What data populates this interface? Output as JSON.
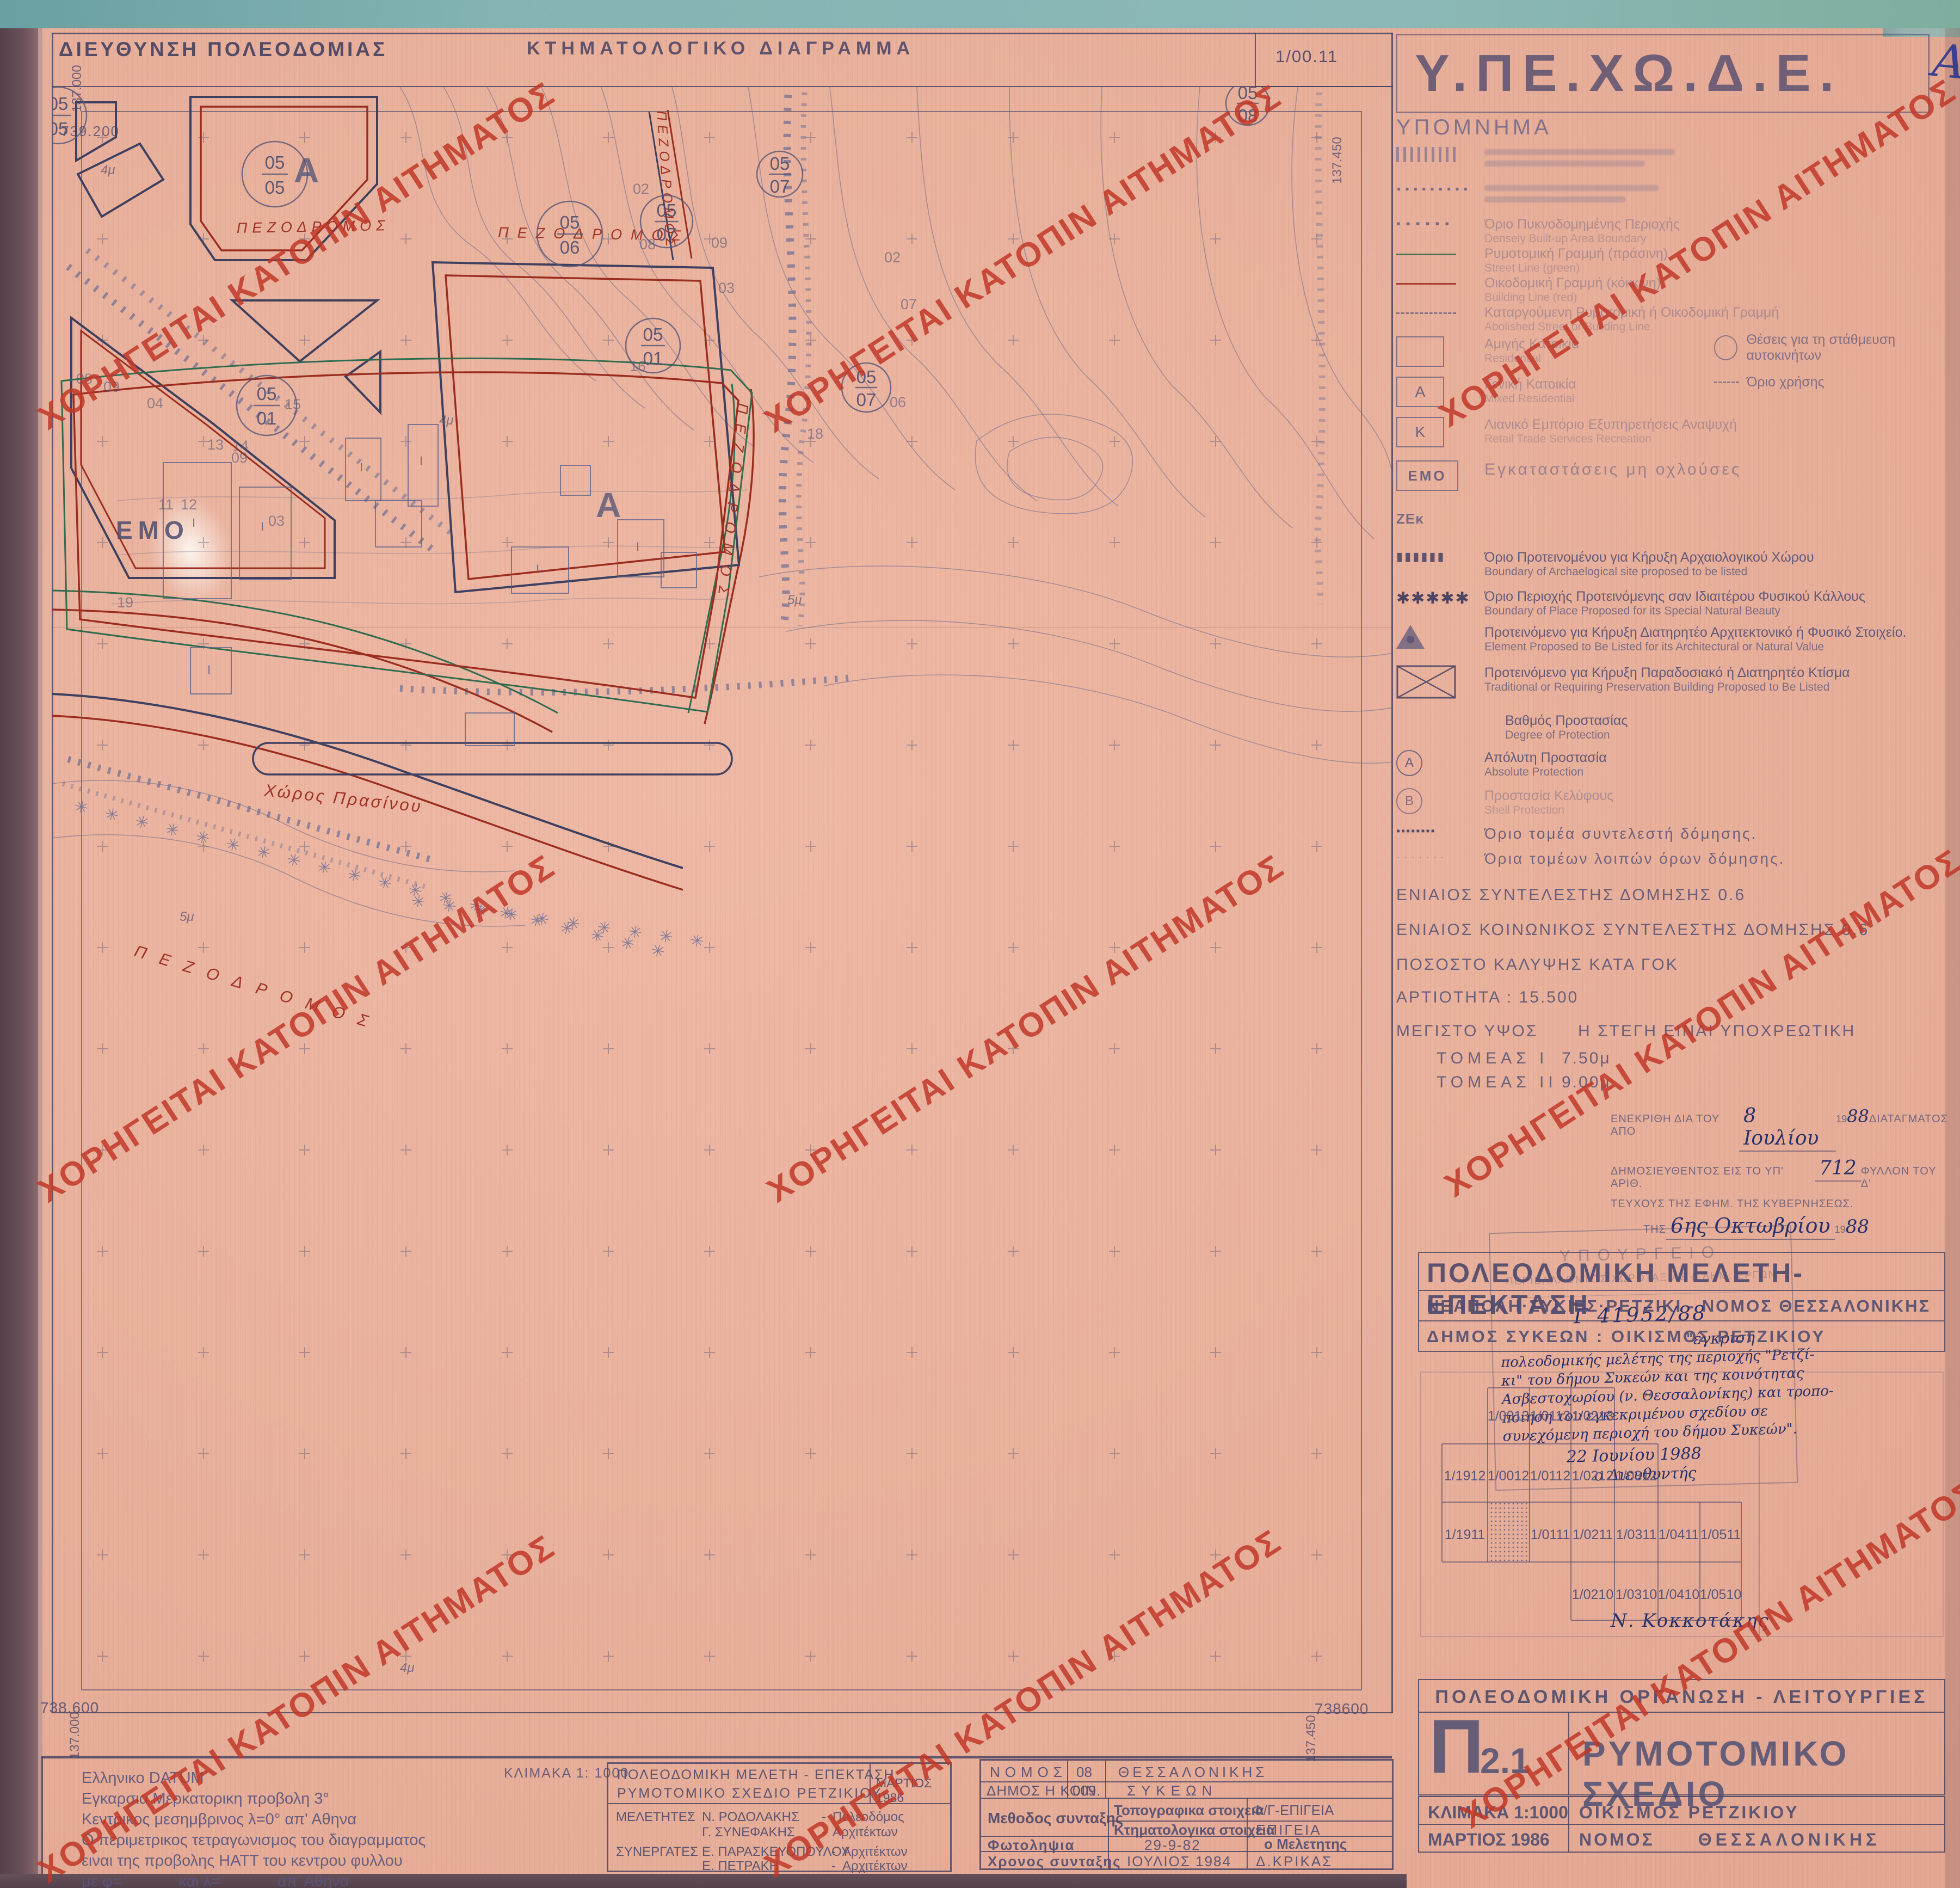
{
  "watermark": {
    "text": "ΧΟΡΗΓΕΙΤΑΙ ΚΑΤΟΠΙΝ ΑΙΤΗΜΑΤΟΣ",
    "color": "#c1372b"
  },
  "header": {
    "left_title": "ΔΙΕΥΘΥΝΣΗ ΠΟΛΕΟΔΟΜΙΑΣ",
    "center_title": "ΚΤΗΜΑΤΟΛΟΓΙΚΟ ΔΙΑΓΡΑΜΜΑ",
    "sheet_no": "1/00.11"
  },
  "map": {
    "corners": {
      "top_n": "739.200",
      "left_e": "137.000",
      "right_e": "137.450",
      "bottom_left_n": "738.600",
      "bottom_right_n": "738600"
    },
    "street_label": "ΠΕΖΟΔΡΟΜΟΣ",
    "green_space": "Χώρος Πρασίνου",
    "emo": "ΕΜΟ",
    "zone_a": "Α",
    "building_mark": "I",
    "stars_long": "✳ ✳ ✳ ✳ ✳ ✳ ✳ ✳ ✳ ✳ ✳ ✳ ✳ ✳ ✳ ✳ ✳ ✳ ✳ ✳",
    "stars_short": "✳ ✳ ✳ ✳ ✳ ✳ ✳ ✳ ✳ ✳",
    "circles": [
      {
        "t": "05",
        "b": "05"
      },
      {
        "t": "05",
        "b": "05"
      },
      {
        "t": "05",
        "b": "06"
      },
      {
        "t": "05",
        "b": "07"
      },
      {
        "t": "05",
        "b": "07"
      },
      {
        "t": "05",
        "b": "01"
      },
      {
        "t": "05",
        "b": "01"
      },
      {
        "t": "05",
        "b": "07"
      },
      {
        "t": "05",
        "b": "08"
      }
    ],
    "plots": [
      "08",
      "09",
      "04",
      "09",
      "03",
      "11",
      "12",
      "13",
      "14",
      "15",
      "19",
      "16",
      "18",
      "02",
      "07",
      "06",
      "08",
      "09",
      "02",
      "03"
    ],
    "dims": [
      "4μ",
      "4μ",
      "5μ",
      "5μ",
      "4μ"
    ]
  },
  "panel": {
    "agency": "Υ.ΠΕ.ΧΩ.Δ.Ε.",
    "annotation_a": "A",
    "legend_title": "ΥΠΟΜΝΗΜΑ",
    "zek": "ΖΕκ",
    "syms": {
      "sq_dots": "▪ ▪ ▪ ▪ ▪ ▪",
      "dots": "·········",
      "arch": "▮▮▮▮▮▮",
      "stars": "✱✱✱✱✱",
      "dot_row": "▪▪▪▪▪▪▪▪",
      "dot_faint": "· · · · · · ·",
      "rect_a": "Α",
      "rect_k": "Κ",
      "rect_emo": "ΕΜΟ",
      "circ_a": "Α",
      "circ_b": "Β"
    },
    "items": [
      {
        "gr": "Όριο Πυκνοδομημένης Περιοχής",
        "en": "Densely Built-up Area Boundary"
      },
      {
        "gr": "Ρυμοτομική Γραμμή (πράσινη)",
        "en": "Street Line (green)"
      },
      {
        "gr": "Οικοδομική Γραμμή (κόκκινη)",
        "en": "Building Line (red)"
      },
      {
        "gr": "Καταργούμενη Ρυμοτομική ή Οικοδομική Γραμμή",
        "en": "Abolished Street or Building Line"
      },
      {
        "gr": "Αμιγής Κατοικία",
        "en": "Residential"
      },
      {
        "gr": "Γενική Κατοικία",
        "en": "Mixed Residential"
      },
      {
        "gr": "Λιανικό Εμπόριο Εξυπηρετήσεις Αναψυχή",
        "en": "Retail Trade Services Recreation"
      },
      {
        "gr": "Εγκαταστάσεις μη οχλούσες",
        "en": ""
      },
      {
        "gr": "Όριο Προτεινομένου για Κήρυξη Αρχαιολογικού Χώρου",
        "en": "Boundary of Archaelogical site proposed to be listed"
      },
      {
        "gr": "Όριο Περιοχής Προτεινόμενης σαν Ιδιαιτέρου Φυσικού Κάλλους",
        "en": "Boundary of Place Proposed for its Special Natural Beauty"
      },
      {
        "gr": "Προτεινόμενο για Κήρυξη Διατηρητέο Αρχιτεκτονικό ή Φυσικό Στοιχείο.",
        "en": "Element Proposed to Be Listed for its Architectural or Natural Value"
      },
      {
        "gr": "Προτεινόμενο για Κήρυξη Παραδοσιακό ή Διατηρητέο Κτίσμα",
        "en": "Traditional or Requiring Preservation Building Proposed to Be Listed"
      },
      {
        "gr": "Βαθμός Προστασίας",
        "en": "Degree of Protection"
      },
      {
        "gr": "Απόλυτη Προστασία",
        "en": "Absolute Protection"
      },
      {
        "gr": "Προστασία Κελύφους",
        "en": "Shell Protection"
      },
      {
        "gr": "Όριο τομέα συντελεστή δόμησης.",
        "en": ""
      },
      {
        "gr": "Όρια τομέων λοιπών όρων δόμησης.",
        "en": ""
      }
    ],
    "parking": "Θέσεις για τη στάθμευση αυτοκινήτων",
    "use_boundary": "Όριο χρήσης",
    "regulations": [
      "ΕΝΙΑΙΟΣ ΣΥΝΤΕΛΕΣΤΗΣ ΔΟΜΗΣΗΣ 0.6",
      "ΕΝΙΑΙΟΣ ΚΟΙΝΩΝΙΚΟΣ ΣΥΝΤΕΛΕΣΤΗΣ ΔΟΜΗΣΗΣ 0.6",
      "ΠΟΣΟΣΤΟ ΚΑΛΥΨΗΣ ΚΑΤΑ ΓΟΚ",
      "ΑΡΤΙΟΤΗΤΑ : 15.500"
    ],
    "height": {
      "label": "ΜΕΓΙΣΤΟ ΥΨΟΣ",
      "roof_note": "Η ΣΤΕΓΗ ΕΙΝΑΙ ΥΠΟΧΡΕΩΤΙΚΗ",
      "s1": "ΤΟΜΕΑΣ Ι",
      "s1v": "7.50μ",
      "s2": "ΤΟΜΕΑΣ ΙΙ",
      "s2v": "9.00μ"
    },
    "approval": {
      "l1a": "ΕΝΕΚΡΙΘΗ ΔΙΑ ΤΟΥ ΑΠΟ",
      "l1hw": "8 Ιουλίου",
      "y1": "19",
      "y1hw": "88",
      "l1b": "ΔΙΑΤΑΓΜΑΤΟΣ",
      "l2a": "ΔΗΜΟΣΙΕΥΘΕΝΤΟΣ ΕΙΣ ΤΟ ΥΠ' ΑΡΙΘ.",
      "l2hw": "712",
      "l2b": "ΦΥΛΛΟΝ ΤΟΥ Δ'",
      "l3": "ΤΕΥΧΟΥΣ ΤΗΣ ΕΦΗΜ. ΤΗΣ ΚΥΒΕΡΝΗΣΕΩΣ.",
      "l4a": "ΤΗΣ",
      "l4hw": "6ης Οκτωβρίου",
      "y4": "19",
      "y4hw": "88"
    },
    "stamp": {
      "h1": "ΥΠΟΥΡΓΕΙΟ",
      "h2": "ΠΕΡΙΒΑΛΛΟΝΤΟΣ ΧΩΡΟΤΑΞΙΑΣ & ΔΗΜ. ΕΡΓΩΝ",
      "protocol": "Γ 41952/88",
      "lines": [
        "\"έγκριση",
        "πολεοδομικής μελέτης της περιοχής \"Ρετζί-",
        "κι\" του δήμου Συκεών και της κοινότητας",
        "Ασβεστοχωρίου (ν. Θεσσαλονίκης) και τροπο-",
        "ποίηση του εγκεκριμένου σχεδίου σε",
        "συνεχόμενη περιοχή του δήμου Συκεών\".",
        "22 Ιουνίου 1988",
        "ο Διευθυντής"
      ],
      "signature": "Ν. Κοκκοτάκης"
    },
    "project": {
      "title": "ΠΟΛΕΟΔΟΜΙΚΗ ΜΕΛΕΤΗ-ΕΠΕΚΤΑΣΗ",
      "subtitle": "ΝΕΑΠΟΛΗ·ΣΥΚΙΕΣ·ΡΕΤΖΙΚΙ - ΝΟΜΟΣ ΘΕΣΣΑΛΟΝΙΚΗΣ",
      "municipality": "ΔΗΜΟΣ ΣΥΚΕΩΝ : ΟΙΚΙΣΜΟΣ ΡΕΤΖΙΚΙΟΥ"
    },
    "index": {
      "row1": [
        "1/0013",
        "1/0113",
        "1/0213"
      ],
      "row2": [
        "1/1912",
        "1/0012",
        "1/0112",
        "1/0212",
        "1/0312"
      ],
      "row3": [
        "1/1911",
        "1/0111",
        "1/0211",
        "1/0311",
        "1/0411",
        "1/0511"
      ],
      "row4": [
        "1/0210",
        "1/0310",
        "1/0410",
        "1/0510"
      ]
    },
    "title_block": {
      "header": "ΠΟΛΕΟΔΟΜΙΚΗ ΟΡΓΑΝΩΣΗ - ΛΕΙΤΟΥΡΓΙΕΣ",
      "code_letter": "Π",
      "code_no": "2.1",
      "name": "ΡΥΜΟΤΟΜΙΚΟ ΣΧΕΔΙΟ",
      "scale": "ΚΛΙΜΑΚΑ 1:1000",
      "settlement": "ΟΙΚΙΣΜΟΣ ΡΕΤΖΙΚΙΟΥ",
      "date": "ΜΑΡΤΙΟΣ 1986",
      "pref_label": "ΝΟΜΟΣ",
      "pref_value": "ΘΕΣΣΑΛΟΝΙΚΗΣ"
    }
  },
  "bottom": {
    "datum": [
      "Ελληνικο DATUM",
      "Εγκαρσια Μερκατορικη προβολη 3°",
      "Κεντρικος μεσημβρινος λ=0° απ' Αθηνα",
      "Ο περιμετρικος τετραγωνισμος του διαγραμματος",
      "ειναι της προβολης ΗΑΤΤ του κεντρου φυλλου",
      "με φ=             και λ=             απ' Αθηνα"
    ],
    "scale_label": "ΚΛΙΜΑΚΑ 1: 1000",
    "study": {
      "t1": "ΠΟΛΕΟΔΟΜΙΚΗ ΜΕΛΕΤΗ - ΕΠΕΚΤΑΣΗ",
      "t2": "ΡΥΜΟΤΟΜΙΚΟ ΣΧΕΔΙΟ ΡΕΤΖΙΚΙΟΥ",
      "date": "ΜΑΡΤΙΟΣ 1986",
      "l1": "ΜΕΛΕΤΗΤΕΣ",
      "c": ":",
      "d": "-",
      "n1": "Ν. ΡΟΔΟΛΑΚΗΣ",
      "r1": "Πολεοδόμος",
      "n2": "Γ. ΣΥΝΕΦΑΚΗΣ",
      "r2": "Αρχιτέκτων",
      "l2": "ΣΥΝΕΡΓΑΤΕΣ",
      "n3": "Ε. ΠΑΡΑΣΚΕΥΟΠΟΥΛΟΥ",
      "r3": "Αρχιτέκτων",
      "n4": "Ε. ΠΕΤΡΑΚΗ",
      "r4": "Αρχιτέκτων"
    },
    "admin": {
      "nomos": "ΝΟΜΟΣ",
      "nomos_code": "08",
      "nomos_v": "ΘΕΣΣΑΛΟΝΙΚΗΣ",
      "dimos": "ΔΗΜΟΣ Η ΚΟΙΝ.",
      "dimos_code": "009",
      "dimos_v": "ΣΥΚΕΩΝ",
      "method": "Μεθοδος συνταξης",
      "topo": "Τοπογραφικα στοιχεια",
      "topo_v": "Φ/Γ-ΕΠΙΓΕΙΑ",
      "ktima": "Κτηματολογικα στοιχεια",
      "ktima_v": "ΕΠΙΓΕΙΑ",
      "photo": "Φωτοληψια",
      "photo_v": "29-9-82",
      "meletitis": "ο Μελετητης",
      "time": "Χρονος συνταξης",
      "time_v": "ΙΟΥΛΙΟΣ 1984",
      "name": "Δ.ΚΡΙΚΑΣ"
    }
  }
}
